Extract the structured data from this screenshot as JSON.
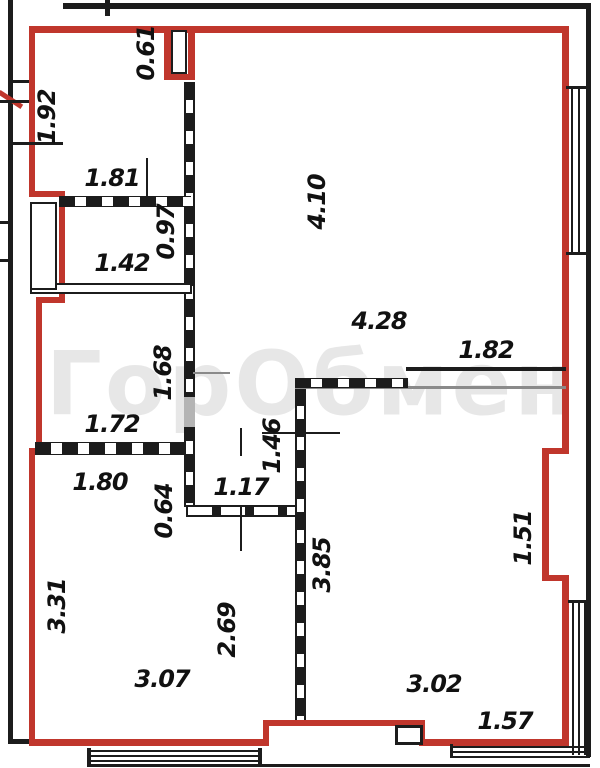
{
  "watermark": {
    "text": "ГорОбмен"
  },
  "colors": {
    "boundary_wall_red": "#c0362c",
    "line_black": "#1c1c1c",
    "dimension_text": "#111111",
    "thin_gray_line": "#8a8a8a",
    "watermark_gray": "#e8e8e8"
  },
  "dims": [
    {
      "value": "0.61",
      "orientation": "vertical"
    },
    {
      "value": "1.92",
      "orientation": "vertical"
    },
    {
      "value": "1.81",
      "orientation": "horizontal"
    },
    {
      "value": "0.97",
      "orientation": "vertical"
    },
    {
      "value": "1.42",
      "orientation": "horizontal"
    },
    {
      "value": "4.10",
      "orientation": "vertical"
    },
    {
      "value": "4.28",
      "orientation": "horizontal"
    },
    {
      "value": "1.82",
      "orientation": "horizontal"
    },
    {
      "value": "1.68",
      "orientation": "vertical"
    },
    {
      "value": "1.72",
      "orientation": "horizontal"
    },
    {
      "value": "1.46",
      "orientation": "vertical"
    },
    {
      "value": "1.80",
      "orientation": "horizontal"
    },
    {
      "value": "0.64",
      "orientation": "vertical"
    },
    {
      "value": "1.17",
      "orientation": "horizontal"
    },
    {
      "value": "3.85",
      "orientation": "vertical"
    },
    {
      "value": "1.51",
      "orientation": "vertical"
    },
    {
      "value": "3.31",
      "orientation": "vertical"
    },
    {
      "value": "2.69",
      "orientation": "vertical"
    },
    {
      "value": "3.07",
      "orientation": "horizontal"
    },
    {
      "value": "3.02",
      "orientation": "horizontal"
    },
    {
      "value": "1.57",
      "orientation": "horizontal"
    }
  ]
}
